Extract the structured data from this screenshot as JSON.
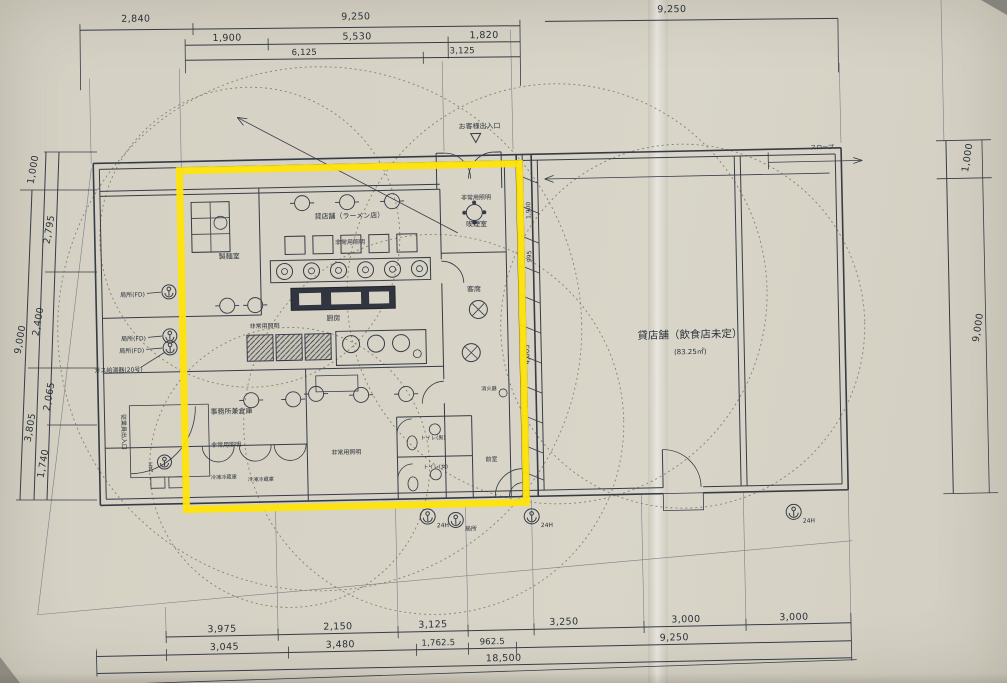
{
  "photo": {
    "paper_color": "#d6d2c5",
    "line_color": "#363b47",
    "highlight_color": "#ffe408"
  },
  "dimensions": {
    "top_row1": [
      "2,840",
      "9,250"
    ],
    "top_row2": [
      "1,900",
      "5,530",
      "1,820"
    ],
    "top_row3": [
      "6,125",
      "3,125"
    ],
    "top_right": "9,250",
    "left": {
      "top": "1,000",
      "total": "9,000",
      "seg1": "2,795",
      "seg2": "2,400",
      "seg3": "2,065",
      "seg4": "1,740",
      "sub": "3,805"
    },
    "right": {
      "top": "1,000",
      "total": "9,000"
    },
    "bottom_row1": [
      "3,975",
      "2,150",
      "3,125",
      "3,250",
      "3,000",
      "3,000"
    ],
    "bottom_row2": [
      "3,045",
      "3,480",
      "1,762.5",
      "962.5",
      "9,250"
    ],
    "bottom_total": "18,500",
    "interior": {
      "d1": "1,900",
      "d2": "995",
      "d3": "4,005"
    }
  },
  "rooms": {
    "ramen_shop": "貸店舗（ラーメン店）",
    "noodle_room": "製麺室",
    "smoking_room": "喫煙室",
    "seating": "客席",
    "kitchen": "厨房",
    "office_storage": "事務所兼倉庫",
    "fridge": "冷凍冷蔵庫",
    "toilet_m": "トイレ(男)",
    "toilet_f": "トイレ(女)",
    "anteroom": "前室",
    "vacant_shop": "貸店舗（飲食店未定）",
    "vacant_shop_area": "(83.25㎡)"
  },
  "annotations": {
    "customer_entrance": "お客様出入口",
    "employee_entrance": "従業員出入口",
    "slope": "スロープ",
    "emergency_light": "非常用照明",
    "fire_extinguisher": "消火器",
    "fan_24h": "24H",
    "fan_local": "局所",
    "local_fd": "局所(FD)",
    "gas_heater": "ガス給湯器(20号)"
  }
}
